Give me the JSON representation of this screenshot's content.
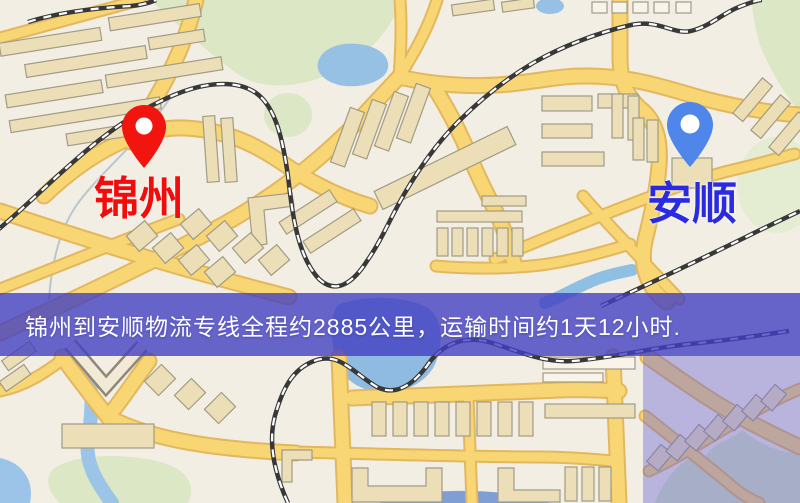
{
  "route": {
    "origin": {
      "label": "锦州",
      "pin_color": "#f2150f",
      "label_color": "#f20d0d"
    },
    "destination": {
      "label": "安顺",
      "pin_color": "#4e86ea",
      "label_color": "#2a2ae0"
    },
    "distance_km": "2885",
    "duration_text": "1天12小时"
  },
  "banner": {
    "text": "锦州到安顺物流专线全程约2885公里，运输时间约1天12小时.",
    "background_color": "#4240c2",
    "text_color": "#ffffff"
  },
  "map_colors": {
    "background": "#f2eee3",
    "road_fill": "#f8d674",
    "road_border": "#e3b75e",
    "water": "#97c1e4",
    "park": "#dbe7c5",
    "railway": "#383838",
    "building": "#ecdfb8",
    "overlay_tint": "#6864d6"
  }
}
